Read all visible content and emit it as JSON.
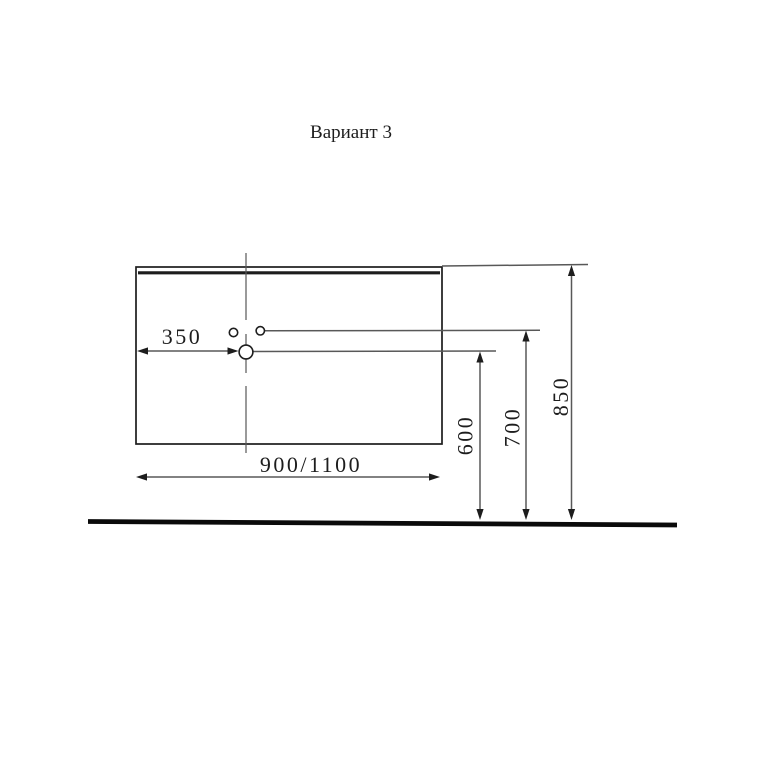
{
  "title": "Вариант 3",
  "colors": {
    "ink": "#1d1d1d",
    "line": "#585858",
    "floor": "#0a0a0a",
    "paper": "#ffffff"
  },
  "drawing": {
    "labels": {
      "offset_350": "350",
      "width_900_1100": "900/1100",
      "height_600": "600",
      "height_700": "700",
      "height_850": "850"
    }
  }
}
